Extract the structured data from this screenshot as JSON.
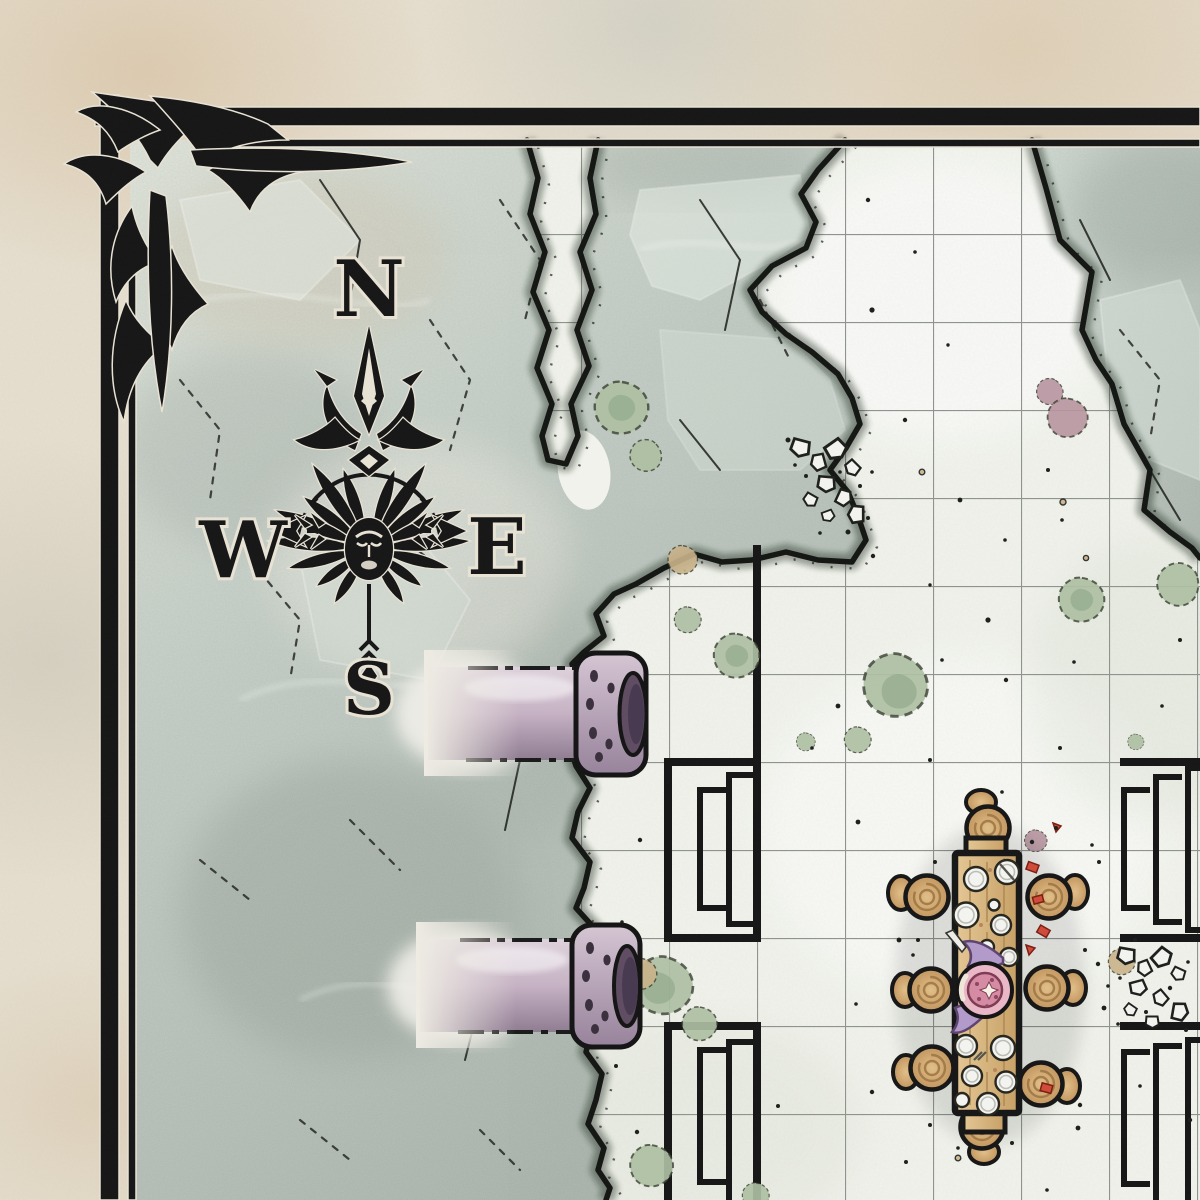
{
  "map": {
    "type": "fantasy-battle-map",
    "compass": {
      "north": "N",
      "east": "E",
      "south": "S",
      "west": "W"
    },
    "palette": {
      "ink": "#161616",
      "halo": "#e9e3d5",
      "marble": "#e7dfcf",
      "rock-light": "#e0e4da",
      "rock": "#bfcac2",
      "rock-dark": "#a5b0a8",
      "floor": "#f1f3ec",
      "grid": "#8f938e",
      "pipe-light": "#ded2dc",
      "pipe": "#c6b2c4",
      "pipe-dark": "#8f7c92",
      "pipe-hole": "#5f4c62",
      "moss": "#aebfa3",
      "moss-dark": "#8ea687",
      "wood-light": "#e5c795",
      "wood-dark": "#c7a065",
      "stool": "#d6ad77",
      "stool-line": "#9b7340",
      "plate": "#f4f4f1",
      "platter": "#eab7c7",
      "roast": "#d58ba3",
      "wing": "#b29aca",
      "red": "#cf4b38",
      "mauve": "#b795a0",
      "tan": "#c9b289"
    },
    "features": [
      {
        "name": "ornate-corner-border"
      },
      {
        "name": "compass-rose"
      },
      {
        "name": "rocky-chasm-ledge"
      },
      {
        "name": "gridded-stone-floor"
      },
      {
        "name": "broken-pipes",
        "count": 2
      },
      {
        "name": "bunk-racks",
        "count": 4
      },
      {
        "name": "banquet-table",
        "count": 1
      },
      {
        "name": "stools",
        "count": 8
      },
      {
        "name": "moss-patches",
        "count": 14
      },
      {
        "name": "rubble-piles",
        "count": 2
      }
    ]
  }
}
